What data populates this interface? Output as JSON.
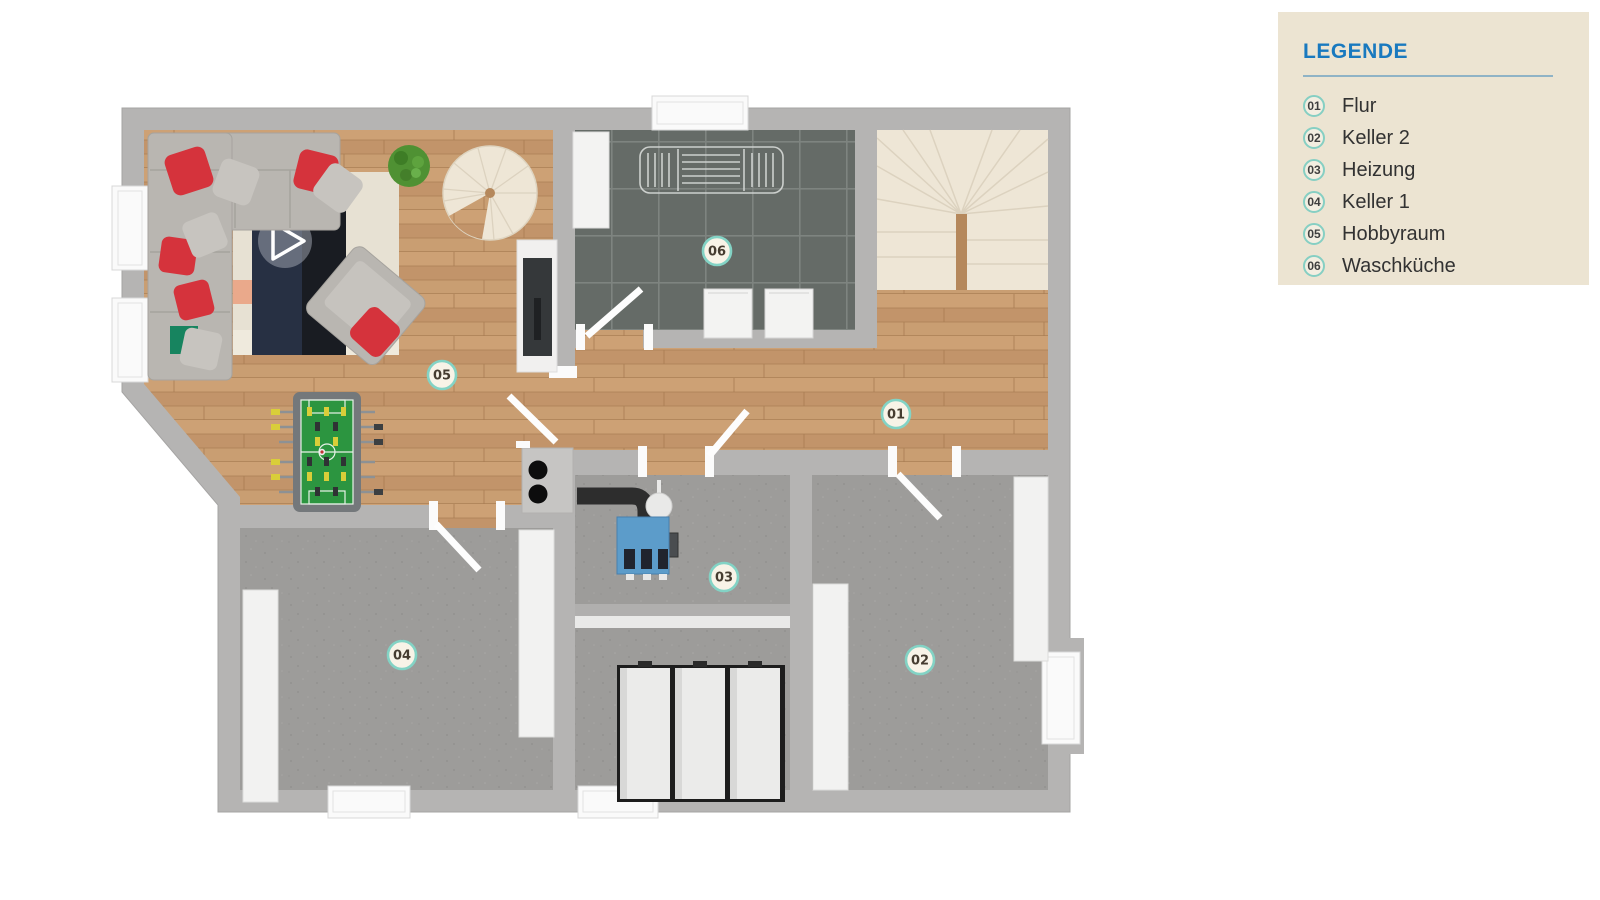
{
  "page": {
    "background": "#ffffff"
  },
  "legend": {
    "title": "LEGENDE",
    "title_color": "#1979bf",
    "panel_bg": "#ece4d2",
    "accent_teal": "#86cfc3",
    "items": [
      {
        "num": "01",
        "label": "Flur"
      },
      {
        "num": "02",
        "label": "Keller 2"
      },
      {
        "num": "03",
        "label": "Heizung"
      },
      {
        "num": "04",
        "label": "Keller 1"
      },
      {
        "num": "05",
        "label": "Hobbyraum"
      },
      {
        "num": "06",
        "label": "Waschküche"
      }
    ]
  },
  "plan": {
    "type": "basement-floor-plan",
    "markers": [
      {
        "num": "01",
        "room": "Flur"
      },
      {
        "num": "02",
        "room": "Keller 2"
      },
      {
        "num": "03",
        "room": "Heizung"
      },
      {
        "num": "04",
        "room": "Keller 1"
      },
      {
        "num": "05",
        "room": "Hobbyraum"
      },
      {
        "num": "06",
        "room": "Waschküche"
      }
    ],
    "colors": {
      "wall": "#b5b4b3",
      "wood_floor": "#c69a6c",
      "tile_floor": "#656b67",
      "concrete_floor": "#9d9c9a",
      "stairs": "#eee6d6",
      "marker_ring": "#83d3c5"
    }
  }
}
